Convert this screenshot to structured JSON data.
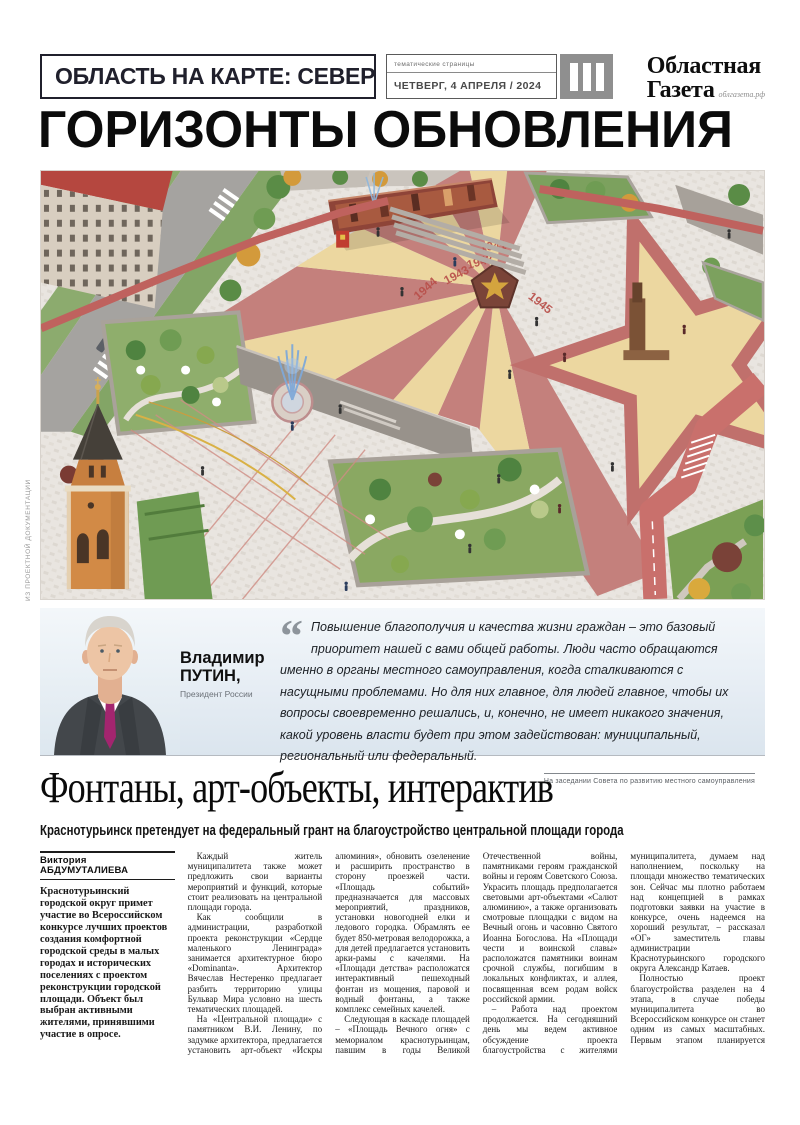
{
  "masthead": {
    "section_title": "ОБЛАСТЬ НА КАРТЕ: СЕВЕР",
    "pages_label": "тематические страницы",
    "date_label": "ЧЕТВЕРГ, 4 АПРЕЛЯ / 2024",
    "page_marker_icon": "three-vertical-bars",
    "logo_line1": "Областная",
    "logo_line2": "Газета",
    "logo_site": "облгазета.рф"
  },
  "headline": "ГОРИЗОНТЫ ОБНОВЛЕНИЯ",
  "photo_credit": "ИЗ ПРОЕКТНОЙ ДОКУМЕНТАЦИИ",
  "render": {
    "description": "aerial-render-of-plaza-with-red-star-paving",
    "year_labels": [
      "1941",
      "1942",
      "1943",
      "1944",
      "1945"
    ],
    "colors": {
      "paving": "#e9e5e0",
      "ray_red": "#c4807c",
      "ray_cream": "#ecd7a0",
      "path_red": "#c9706c",
      "green": "#7ca15e"
    }
  },
  "quote": {
    "quote_mark": "“",
    "speaker_first": "Владимир",
    "speaker_last": "ПУТИН,",
    "speaker_role": "Президент России",
    "text": "Повышение благополучия и качества жизни граждан – это базовый приоритет нашей с вами общей работы. Люди часто обращаются именно в органы местного самоуправления, когда сталкиваются с насущными проблемами. Но для них главное, для людей главное, чтобы их вопросы своевременно решались, и, конечно, не имеет никакого значения, какой уровень власти будет при этом задействован: муниципальный, региональный или федеральный.",
    "attribution": "На заседании Совета по развитию местного самоуправления"
  },
  "article": {
    "title": "Фонтаны, арт-объекты, интерактив",
    "subtitle": "Краснотурьинск претендует на федеральный грант на благоустройство центральной площади города",
    "byline": "Виктория АБДУМУТАЛИЕВА",
    "lead": "Краснотурьинский городской округ примет участие во Всероссийском конкурсе лучших проектов создания комфортной городской среды в малых городах и исторических поселениях с проектом реконструкции городской площади. Объект был выбран активными жителями, принявшими участие в опросе.",
    "paragraphs": [
      "Каждый житель муниципалитета также может предложить свои варианты мероприятий и функций, которые стоит реализовать на центральной площади города.",
      "Как сообщили в администрации, разработкой проекта реконструкции «Сердце маленького Ленинграда» занимается архитектурное бюро «Dominanta». Архитектор Вячеслав Нестеренко предлагает разбить территорию улицы Бульвар Мира условно на шесть тематических площадей.",
      "На «Центральной площади» с памятником В.И. Ленину, по задумке архитектора, предлагается установить арт-объект «Искры алюминия», обновить озеленение и расширить пространство в сторону проезжей части. «Площадь событий» предназначается для массовых мероприятий, праздников, установки новогодней елки и ледового городка. Обрамлять ее будет 850-метровая велодорожка, а для детей предлагается установить арки-рамы с качелями. На «Площади детства» расположатся интерактивный пешеходный фонтан из мощения, паровой и водный фонтаны, а также комплекс семейных качелей.",
      "Следующая в каскаде площадей – «Площадь Вечного огня» с мемориалом краснотурьинцам, павшим в годы Великой Отечественной войны, памятниками героям гражданской войны и героям Советского Союза. Украсить площадь предполагается световыми арт-объектами «Салют алюминию», а также организовать смотровые площадки с видом на Вечный огонь и часовню Святого Иоанна Богослова. На «Площади чести и воинской славы» расположатся памятники воинам срочной службы, погибшим в локальных конфликтах, и аллея, посвященная всем родам войск российской армии.",
      "– Работа над проектом продолжается. На сегодняшний день мы ведем активное обсуждение проекта благоустройства с жителями муниципалитета, думаем над наполнением, поскольку на площади множество тематических зон. Сейчас мы плотно работаем над концепцией в рамках подготовки заявки на участие в конкурсе, очень надеемся на хороший результат, – рассказал «ОГ» заместитель главы администрации Краснотурьинского городского округа Александр Катаев.",
      "Полностью проект благоустройства разделен на 4 этапа, в случае победы муниципалитета во Всероссийском конкурсе он станет одним из самых масштабных. Первым этапом планируется провести работы на «Площади Вечного огня»."
    ],
    "end_mark_icon": "sable-ornament"
  }
}
